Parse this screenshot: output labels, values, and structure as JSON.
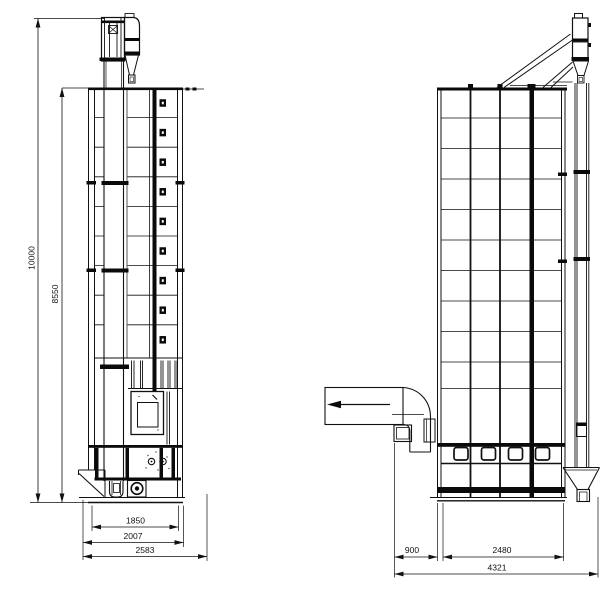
{
  "drawing": {
    "type": "engineering-elevation-drawing",
    "subject": "grain dryer tower, two orthographic views with dimensions",
    "colors": {
      "background": "#ffffff",
      "line": "#111111"
    },
    "symbols": {
      "air_flow_direction": "◀"
    }
  },
  "dimensions": {
    "left_view": {
      "total_height": "10000",
      "body_height": "8550",
      "frame_width": "1850",
      "mid_width": "2007",
      "base_width": "2583"
    },
    "right_view": {
      "duct_offset": "900",
      "body_width": "2480",
      "overall_width": "4321"
    }
  }
}
